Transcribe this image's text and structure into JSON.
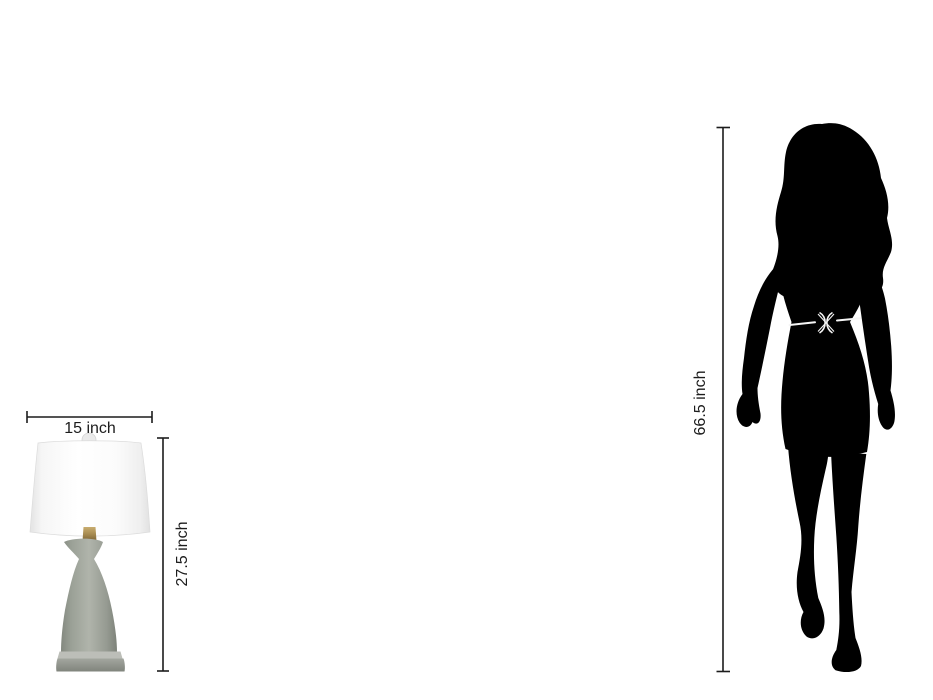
{
  "lamp": {
    "width_label": "15 inch",
    "height_label": "27.5 inch"
  },
  "person": {
    "height_label": "66.5 inch"
  },
  "colors": {
    "bg": "#ffffff",
    "annotation": "#1c1c1c",
    "silhouette": "#000000",
    "belt": "#f5f5f5",
    "lamp_shade": "#ffffff",
    "lamp_shade_edge": "#e3e3e3",
    "lamp_body": "#9aa096",
    "lamp_base": "#8e918a",
    "lamp_brass": "#a88c52",
    "lamp_finial": "#eaeaea"
  }
}
